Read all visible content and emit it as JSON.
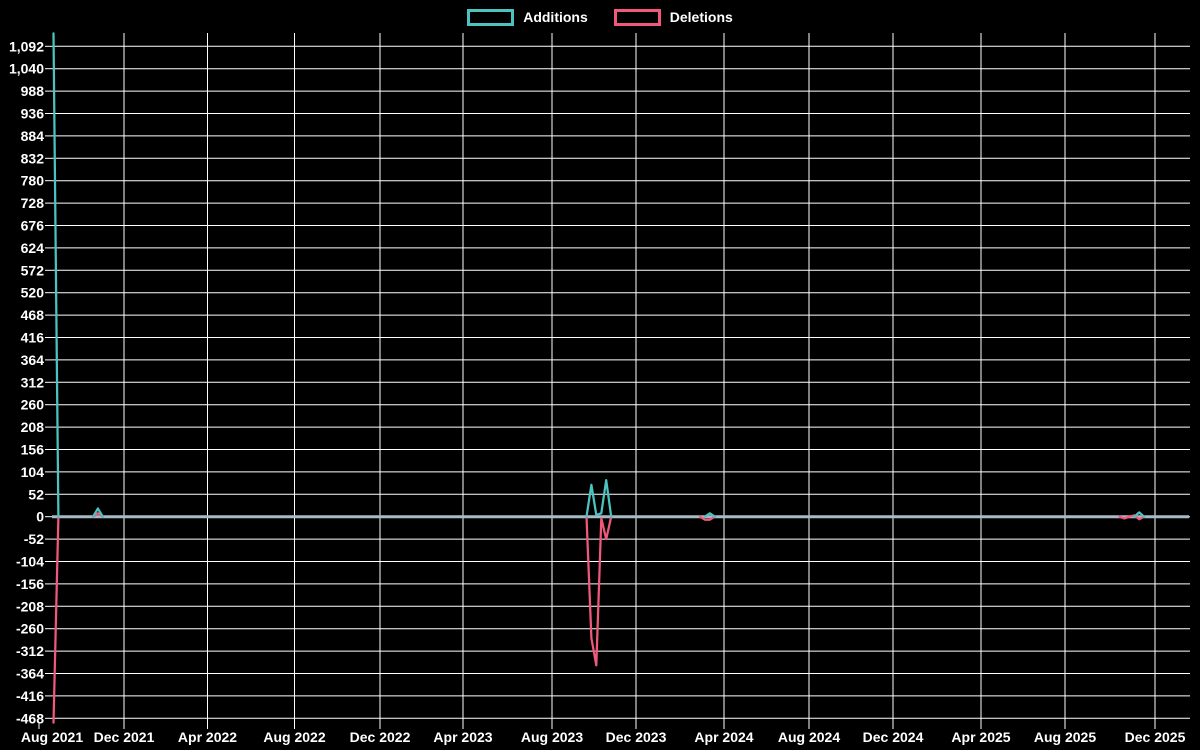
{
  "chart_data": {
    "type": "line",
    "title": "",
    "description": "Weekly code additions (positive) and deletions (negative) from Aug 2021 to Dec 2025, black background, white gridlines",
    "legend": [
      {
        "label": "Additions",
        "color": "#4cc3c0"
      },
      {
        "label": "Deletions",
        "color": "#f0587c"
      }
    ],
    "colors": {
      "background": "#000000",
      "grid": "#ffffff",
      "zero_line": "#a7bbc7",
      "text": "#ffffff",
      "additions": "#4cc3c0",
      "deletions": "#f0587c"
    },
    "y_axis": {
      "min": -468,
      "max": 1092,
      "step": 52,
      "tick_labels": [
        "1,092",
        "1,040",
        "988",
        "936",
        "884",
        "832",
        "780",
        "728",
        "676",
        "624",
        "572",
        "520",
        "468",
        "416",
        "364",
        "312",
        "260",
        "208",
        "156",
        "104",
        "52",
        "0",
        "-52",
        "-104",
        "-156",
        "-208",
        "-260",
        "-312",
        "-364",
        "-416",
        "-468"
      ]
    },
    "x_axis": {
      "tick_labels": [
        "Aug 2021",
        "Dec 2021",
        "Apr 2022",
        "Aug 2022",
        "Dec 2022",
        "Apr 2023",
        "Aug 2023",
        "Dec 2023",
        "Apr 2024",
        "Aug 2024",
        "Dec 2024",
        "Apr 2025",
        "Aug 2025",
        "Dec 2025"
      ],
      "tick_positions_px": [
        39,
        124,
        207.5,
        294.5,
        380,
        463,
        552,
        636,
        724,
        809,
        893,
        981,
        1065,
        1155
      ]
    },
    "weeks_total": 230,
    "series": [
      {
        "name": "Additions",
        "weeks_nonzero": {
          "0": 1122,
          "9": 19,
          "109": 74,
          "110": 4,
          "111": 8,
          "112": 85,
          "133": 8,
          "220": 10
        }
      },
      {
        "name": "Deletions",
        "weeks_nonzero": {
          "0": -478,
          "9": 8,
          "109": -282,
          "110": -345,
          "111": -4,
          "112": -52,
          "132": -7,
          "133": -7,
          "217": -4,
          "219": 3,
          "220": -6
        }
      }
    ],
    "legend_position": "top-center",
    "grid": true
  }
}
